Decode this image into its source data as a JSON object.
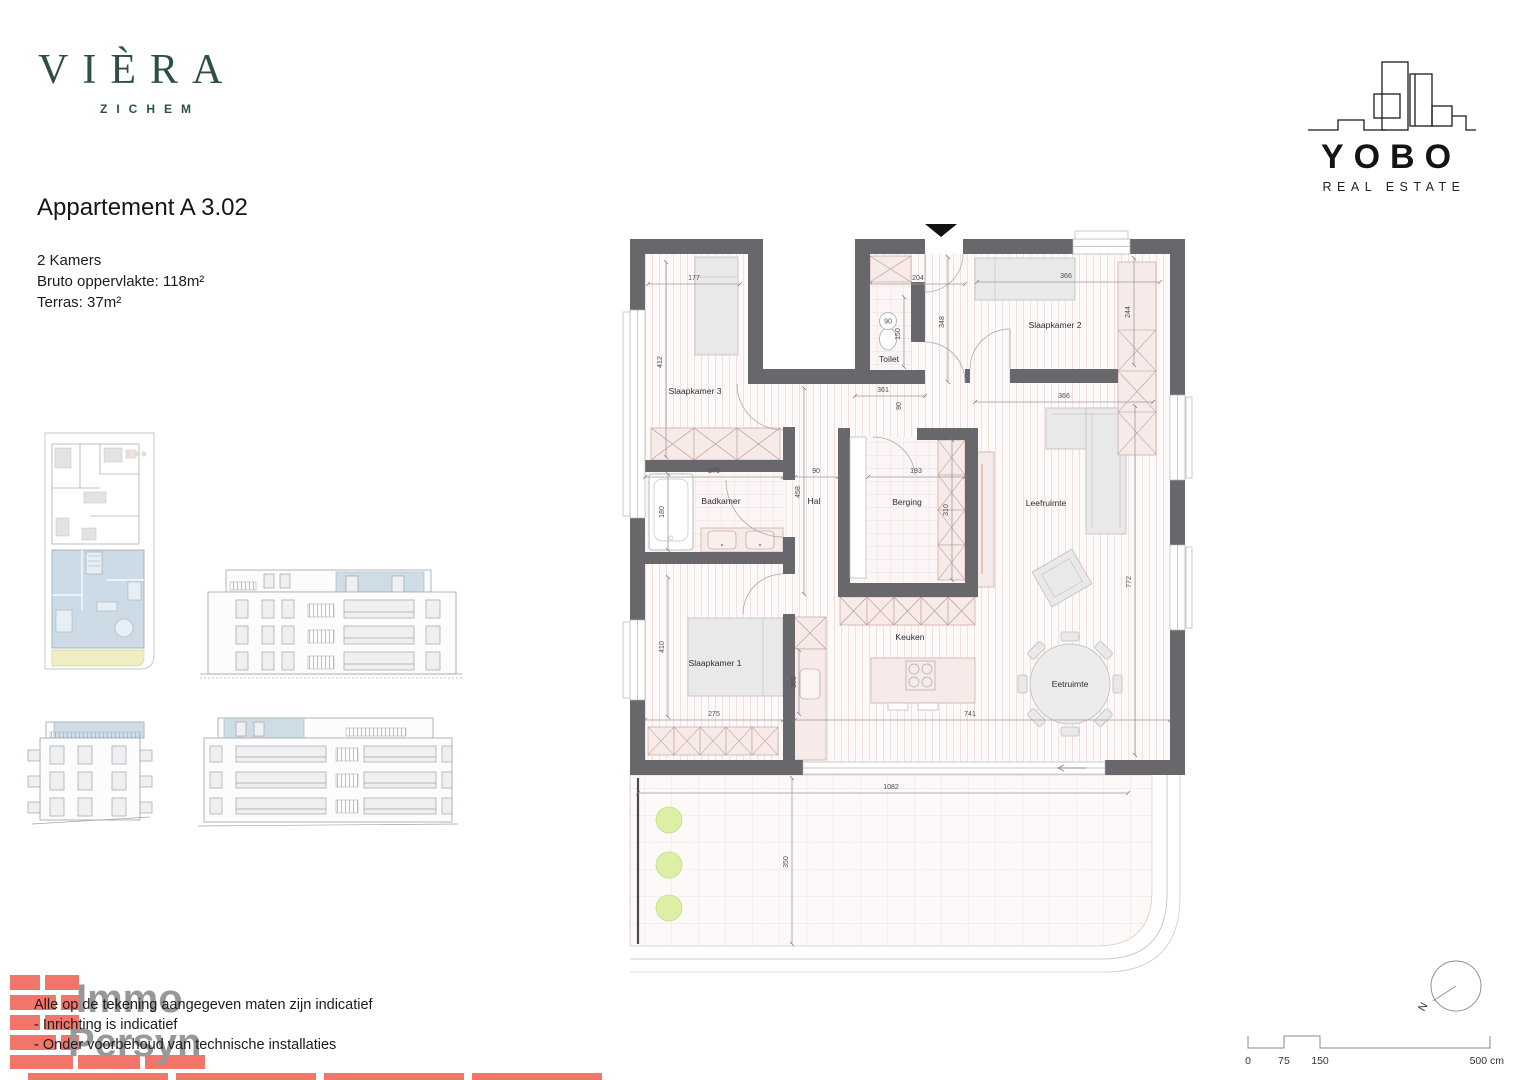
{
  "branding": {
    "viera_name": "VIÈRA",
    "viera_sub": "ZICHEM",
    "yobo_name": "YOBO",
    "yobo_sub": "REAL ESTATE",
    "immo_line1": "Immo",
    "immo_line2": "Persyn"
  },
  "header": {
    "title": "Appartement A 3.02",
    "detail1": "2 Kamers",
    "detail2": "Bruto oppervlakte: 118m²",
    "detail3": "Terras: 37m²"
  },
  "plan": {
    "rooms": {
      "slaapkamer1": "Slaapkamer 1",
      "slaapkamer2": "Slaapkamer 2",
      "slaapkamer3": "Slaapkamer 3",
      "badkamer": "Badkamer",
      "toilet": "Toilet",
      "hal": "Hal",
      "berging": "Berging",
      "leefruimte": "Leefruimte",
      "keuken": "Keuken",
      "eetruimte": "Eetruimte"
    },
    "dims": {
      "s3_w": "177",
      "s3_h": "412",
      "corridor_w": "204",
      "corridor_h": "348",
      "toilet_w": "90",
      "toilet_h": "150",
      "toilet_b_w": "361",
      "toilet_b_h": "90",
      "s2_w": "366",
      "s2_wardrobe": "244",
      "living_top": "366",
      "living_side": "772",
      "bad_w": "275",
      "bad_h": "180",
      "hal_w": "90",
      "hal_h": "458",
      "berging_w": "193",
      "berging_h": "310",
      "s1_w": "275",
      "s1_h": "410",
      "kitchen_cab": "300",
      "kitchen_w": "741",
      "terras_w": "1082",
      "terras_h": "350"
    }
  },
  "footer": {
    "disclaimer1": "Alle op de tekening aangegeven maten zijn indicatief",
    "disclaimer2": "- Inrichting is indicatief",
    "disclaimer3": "- Onder voorbehoud van technische installaties"
  },
  "scalebar": {
    "t0": "0",
    "t75": "75",
    "t150": "150",
    "t500": "500 cm"
  },
  "compass_label": "N",
  "colors": {
    "wall": "#68686c",
    "accent_blue": "#c6d7e2",
    "terrace_yellow": "#efedc3",
    "plant_green": "#dcefa5",
    "brick": "#f2756a",
    "viera_green": "#2e4f47"
  }
}
